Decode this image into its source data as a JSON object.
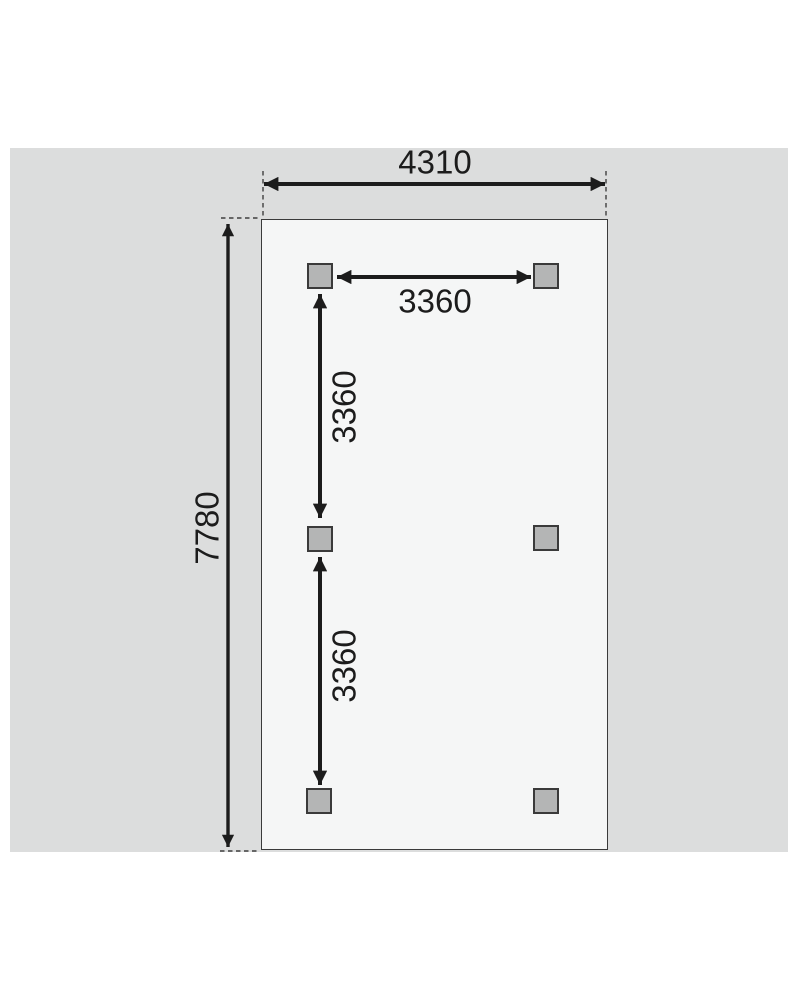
{
  "diagram": {
    "type": "foundation-post-layout-plan",
    "labels": {
      "overall_width": "4310",
      "overall_depth": "7780",
      "post_spacing_top": "3360",
      "post_spacing_left_upper": "3360",
      "post_spacing_left_lower": "3360"
    },
    "posts": {
      "count": 6,
      "arrangement": "2 columns x 3 rows"
    },
    "colors": {
      "canvas_background": "#dcdddd",
      "plan_fill": "#f5f6f6",
      "post_fill": "#b4b5b5",
      "line": "#1c1c1c",
      "outline": "#3a3a3a"
    }
  }
}
